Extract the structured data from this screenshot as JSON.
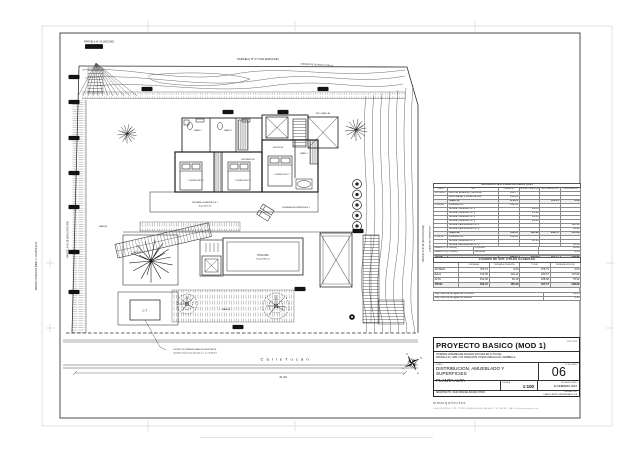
{
  "titleblock": {
    "project_title": "PROYECTO BASICO (MOD 1)",
    "exp": "EXP. 2012",
    "address_line1": "VIVIENDA UNIFAMILIAR AISLADA SITUADA EN C/ TUCAN,",
    "address_line2": "PARCELA 22, URB. LOS NARANJOS, NUEVA ANDALUCIA, MARBELLA",
    "plano_label": "PLANO:",
    "plano_line1": "DISTRIBUCION, AMUEBLADO  Y SUPERFICIES",
    "plano_line2": "PLANTA ALTA",
    "sheet_no_label": "Nº DE PLANO",
    "sheet_no": "06",
    "escala_label": "ESCALA",
    "escala": "1:100",
    "fecha_label": "FECHA DE PLANO",
    "fecha": "16  FEBRERO  2016",
    "arquitecto": "ARQUITECTO:  JUAN MANUEL BAURA CHONI",
    "promotor_label": "PROMOTOR:",
    "promotor": "LANDS GRUPO INMOBILIARIO S.A",
    "firm": "mmarquitectos",
    "firm_info": "CASA CRISTINA 4/5, 2ºB - 1ºB EDF. MALAGA PLAZA, MALAGA - T. 670 888 907 - MAIL: info@mmarquitectos.com"
  },
  "tables": {
    "side_label": "CUADRO DE SUPERFICIES",
    "superficies": {
      "title": "SUPERFICIES CONSTRUIDAS (m2)",
      "headers": [
        "Planta",
        "Uso",
        "Cerrada m2",
        "Terraza Cubierta (m2)",
        "Total Cubierta (m2)",
        "T. descubierta m2"
      ],
      "rows": [
        [
          "SOTANO",
          "Zona de Estancia y servicios",
          "243.77",
          "",
          "",
          ""
        ],
        [
          "",
          "Zona Garaje y zonas de inst.",
          "132.95",
          "",
          "",
          ""
        ],
        [
          "",
          "Total P.S.",
          "376.72",
          "",
          "376.72",
          "0.00"
        ],
        [
          "P. BAJA",
          "Vivienda P.B.",
          "113.45",
          "",
          "",
          ""
        ],
        [
          "",
          "Terraza Cubierta P.B. 1",
          "",
          "29.66",
          "",
          ""
        ],
        [
          "",
          "Terraza Cubierta P.B. 2",
          "",
          "23.32",
          "",
          ""
        ],
        [
          "",
          "Terraza Cubierta P.B. 3",
          "",
          "16.23",
          "",
          ""
        ],
        [
          "",
          "Terraza Cubierta P.B. 4",
          "",
          "49.91",
          "",
          ""
        ],
        [
          "",
          "Terraza Descubierta P.B. 1",
          "",
          "",
          "",
          "122.40"
        ],
        [
          "",
          "Terraza Descubierta P.B. 2",
          "",
          "",
          "",
          "50.20"
        ],
        [
          "",
          "Total P.B.",
          "113.45",
          "119.12",
          "232.57",
          "172.60"
        ],
        [
          "P. ALTA",
          "Vivienda P.A.",
          "152.30",
          "",
          "",
          ""
        ],
        [
          "",
          "Terraza Cubierta P.A. 1",
          "",
          "36.18",
          "",
          ""
        ],
        [
          "",
          "Terraza Descubierta P.A. 1",
          "",
          "",
          "",
          "45.10"
        ],
        [
          "",
          "Terraza Descubierta P.A. 2",
          "",
          "",
          "",
          "30.22"
        ],
        [
          "",
          "Total P.A.",
          "152.30",
          "36.18",
          "188.48",
          "75.32"
        ],
        [
          "TOTAL",
          "",
          "642.47",
          "155.30",
          "797.77",
          "248.92"
        ]
      ],
      "annex_rows": [
        [
          "ANEXO I  (P. BAJA)",
          "PISCINA",
          "39.68"
        ],
        [
          "ANEXO II  (P. BAJA)",
          "JACUZZI",
          "4.48"
        ]
      ]
    },
    "utiles": {
      "title": "CUADRO DE SUP. UTILES GLOBALES",
      "headers": [
        "",
        "CERRADA",
        "TERRAZA CUBIERTA",
        "TOTAL",
        "TERRAZA DESCUB."
      ],
      "rows": [
        [
          "SOTANO",
          "376.72",
          "0.00",
          "376.72",
          "0.00"
        ],
        [
          "BAJA",
          "113.45",
          "119.12",
          "232.57",
          "172.60"
        ],
        [
          "ALTA",
          "152.30",
          "36.18",
          "188.48",
          "75.32"
        ],
        [
          "TOTAL",
          "642.47",
          "155.30",
          "797.77",
          "248.92"
        ]
      ],
      "notes": [
        [
          "Sup. Lámina de agua de PISCINA",
          "39.68"
        ],
        [
          "Sup. Lámina de agua de Jacuzzi",
          "4.48"
        ]
      ]
    }
  },
  "plan": {
    "street_name": "C a l l e     T u c á n",
    "street_dim": "41.36",
    "parcela_top": "PARCELA Nº 27 (SIN EDIFICAR)",
    "parcela_topleft": "PARCELA Nº 30 (VECINO)",
    "parcela_topleft_chip": "Nº 30",
    "lindero_right": "LINDERO DE VECINOS  27.80 ml",
    "parcela_left": "PARCELA Nº 26 (SIN EDIFICAR)",
    "parcela_right": "PARCELA Nº 24 (SIN EDIFICAR)",
    "side_stamp": "PROYECTO BASICO (MOD 1) - PLANTA ALTA",
    "piscina": "PISCINA",
    "piscina_sup": "Sup=39.68 m2",
    "jardin": "JARDIN",
    "ct": "C.T.",
    "ct_note1": "CENTRO DE TRANSFORMACION EXISTENTE.",
    "ct_note2": "Superficie de parcela afectada a C.T. = 20.06 m2",
    "terraza_cub": "TERRAZA CUBIERTA P.A. 1",
    "terraza_cub_sup": "Sup= 36.18 m2",
    "terraza_desc": "TERRAZA DESCUBIERTA P.A. 1",
    "peto": "PETO VARILLAS",
    "rooms": {
      "dorm1": "DORMITORIO 1",
      "dorm2": "DORMITORIO 2",
      "dorm3": "DORMITORIO 3",
      "bano1": "BAÑO 1",
      "bano2": "BAÑO 2",
      "bano3": "BAÑO 3",
      "vestidor": "VESTIDOR",
      "distribuidor": "DISTRIBUIDOR"
    },
    "compass": {
      "n": "N",
      "s": "S",
      "e": "E",
      "o": "O"
    },
    "chips": [
      "18.15",
      "16.73",
      "14.20",
      "12.05",
      "10.90",
      "9.75",
      "8.60",
      "7.45",
      "6.30",
      "5.15",
      "4.40",
      "3.25",
      "2.10",
      "1.05"
    ]
  }
}
